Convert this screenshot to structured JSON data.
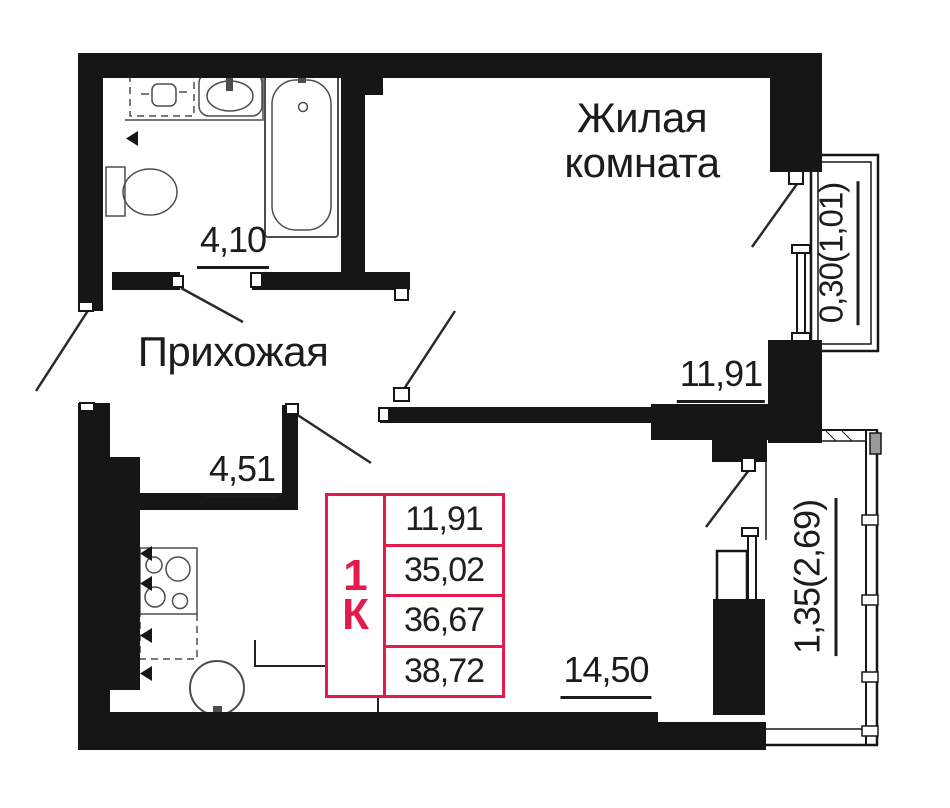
{
  "floorplan": {
    "labels": {
      "living_room_name": "Жилая комната",
      "hallway_name": "Прихожая",
      "bathroom_area": "4,10",
      "hallway_area": "4,51",
      "living_room_area": "11,91",
      "kitchen_living_area": "14,50",
      "balcony_small_area": "0,30(1,01)",
      "balcony_large_area": "1,35(2,69)"
    },
    "info_table": {
      "unit_type_digit": "1",
      "unit_type_letter": "К",
      "rows": [
        "11,91",
        "35,02",
        "36,67",
        "38,72"
      ]
    },
    "colors": {
      "accent": "#E31B4D",
      "wall": "#161616"
    }
  }
}
